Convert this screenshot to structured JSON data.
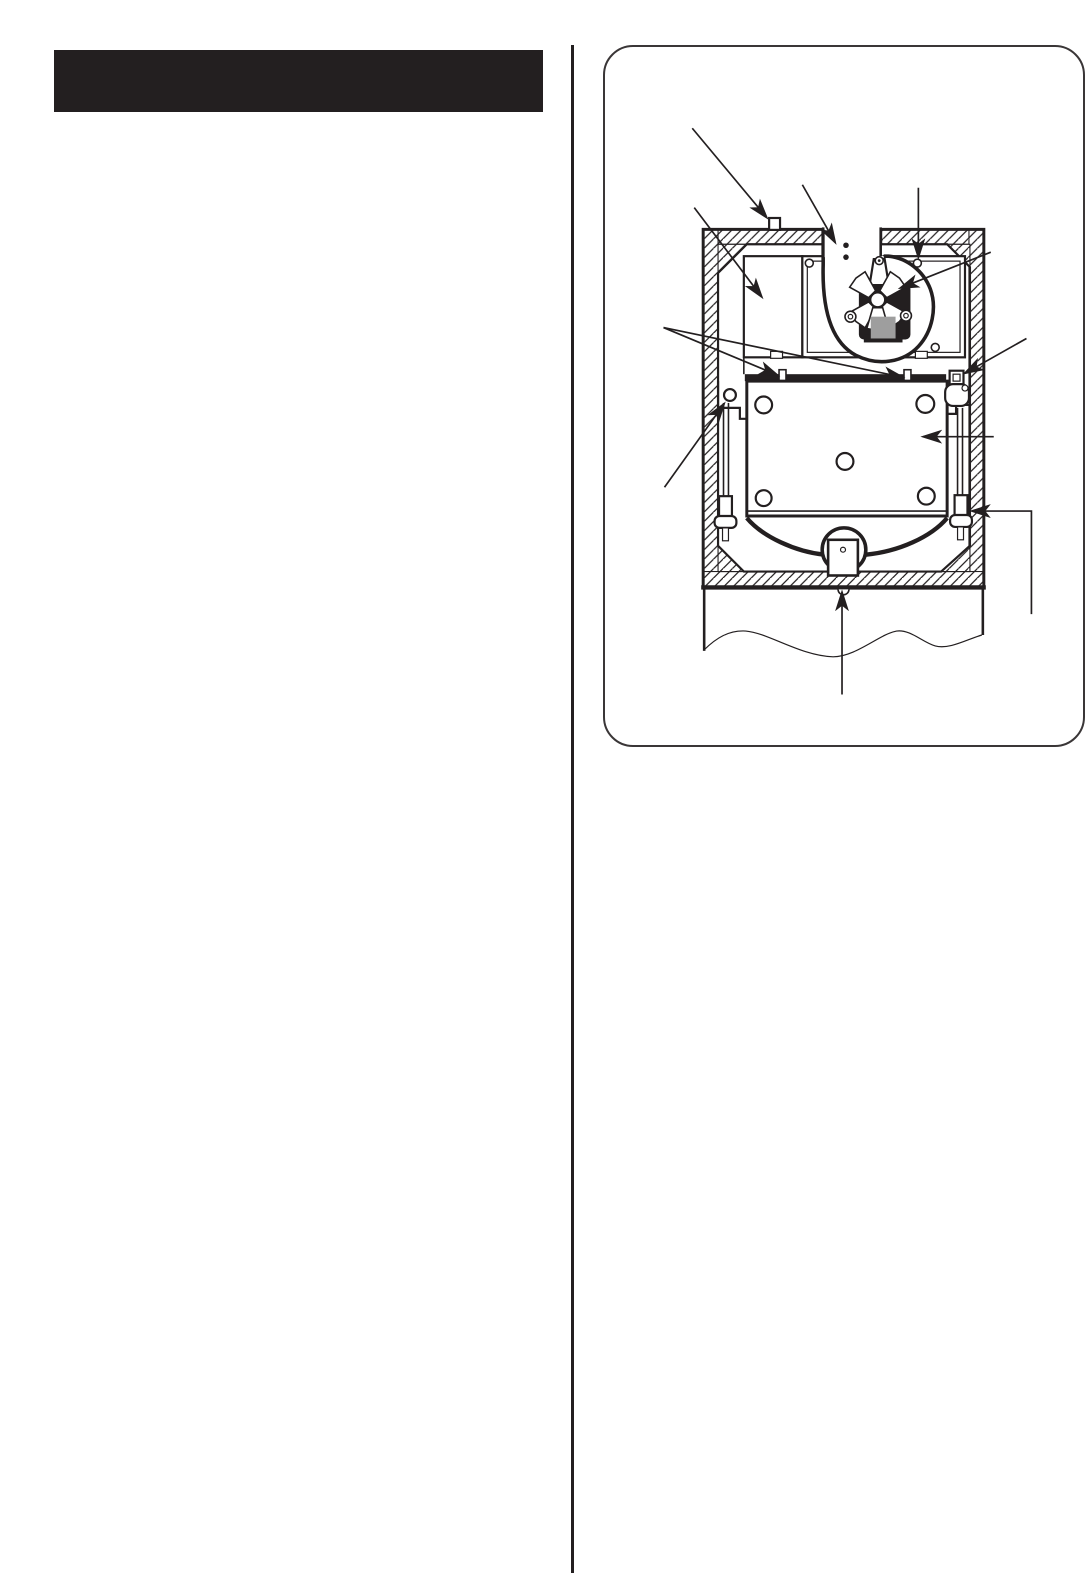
{
  "page": {
    "background": "#ffffff",
    "ink": "#231f20"
  },
  "left_column": {
    "title_bar": {
      "label": "",
      "background": "#231f20"
    }
  },
  "figure": {
    "type": "technical-diagram",
    "subject": "Cross-section of furnace cabinet: blower volute and fan motor at top, control box at left, access plate with holes, side rods with clamps, condensate funnel and drain at bottom, hatched insulated walls",
    "colors": {
      "line": "#231f20",
      "motor_gray": "#9e9e9e",
      "paper": "#ffffff"
    },
    "callouts": [
      {
        "label": "",
        "points_to": "top-panel-cap"
      },
      {
        "label": "",
        "points_to": "flue-chute"
      },
      {
        "label": "",
        "points_to": "panel-screw-top-right"
      },
      {
        "label": "",
        "points_to": "blower-wheel"
      },
      {
        "label": "",
        "points_to": "control-box"
      },
      {
        "label": "",
        "points_to": "bar-clips"
      },
      {
        "label": "",
        "points_to": "valve-fitting"
      },
      {
        "label": "",
        "points_to": "left-grommet"
      },
      {
        "label": "",
        "points_to": "access-plate"
      },
      {
        "label": "",
        "points_to": "right-clamp"
      },
      {
        "label": "",
        "points_to": "drain-outlet"
      }
    ]
  }
}
